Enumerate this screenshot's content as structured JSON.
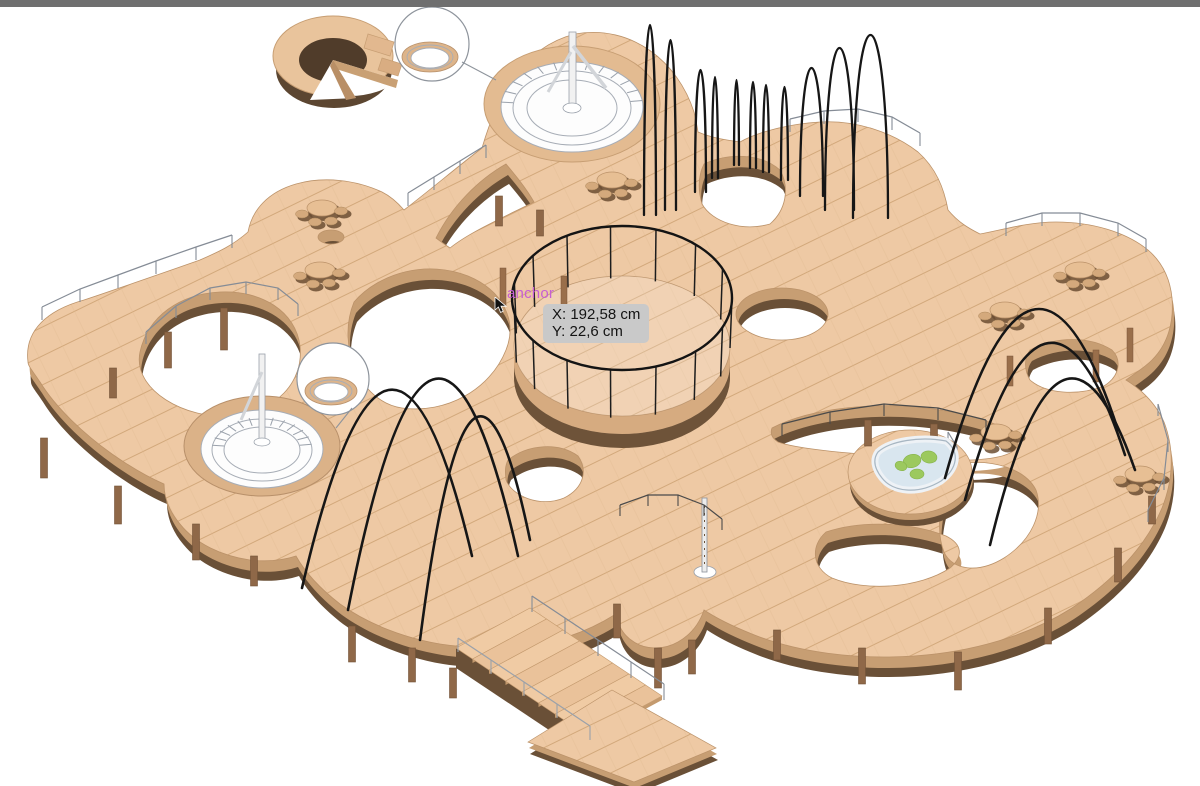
{
  "viewport": {
    "title": "3D wooden deck model viewport",
    "background": "#ffffff",
    "topbar_color": "#6f6f6f"
  },
  "annotation": {
    "anchor_label": "anchor",
    "anchor_color": "#c75fd3"
  },
  "tooltip": {
    "x_readout": "X: 192,58 cm",
    "y_readout": "Y: 22,6 cm",
    "background": "#c9c9c9",
    "text_color": "#141414"
  },
  "palette": {
    "deck_top": "#eec9a4",
    "deck_side": "#c79e73",
    "deck_base": "#6a5037",
    "plank_line": "#d2a87b",
    "support_post": "#8f6848",
    "rope_arch_black": "#161616",
    "railing_gray": "#858c96",
    "pool_water": "#d9e6ef",
    "plant_green": "#9cc95e"
  },
  "scene": {
    "description": "Isometric rendering of multi-level curved wooden decks with circular pavilions, rope arches, hot-tub bowl, planted pool, stairs and detail callout balloons"
  }
}
